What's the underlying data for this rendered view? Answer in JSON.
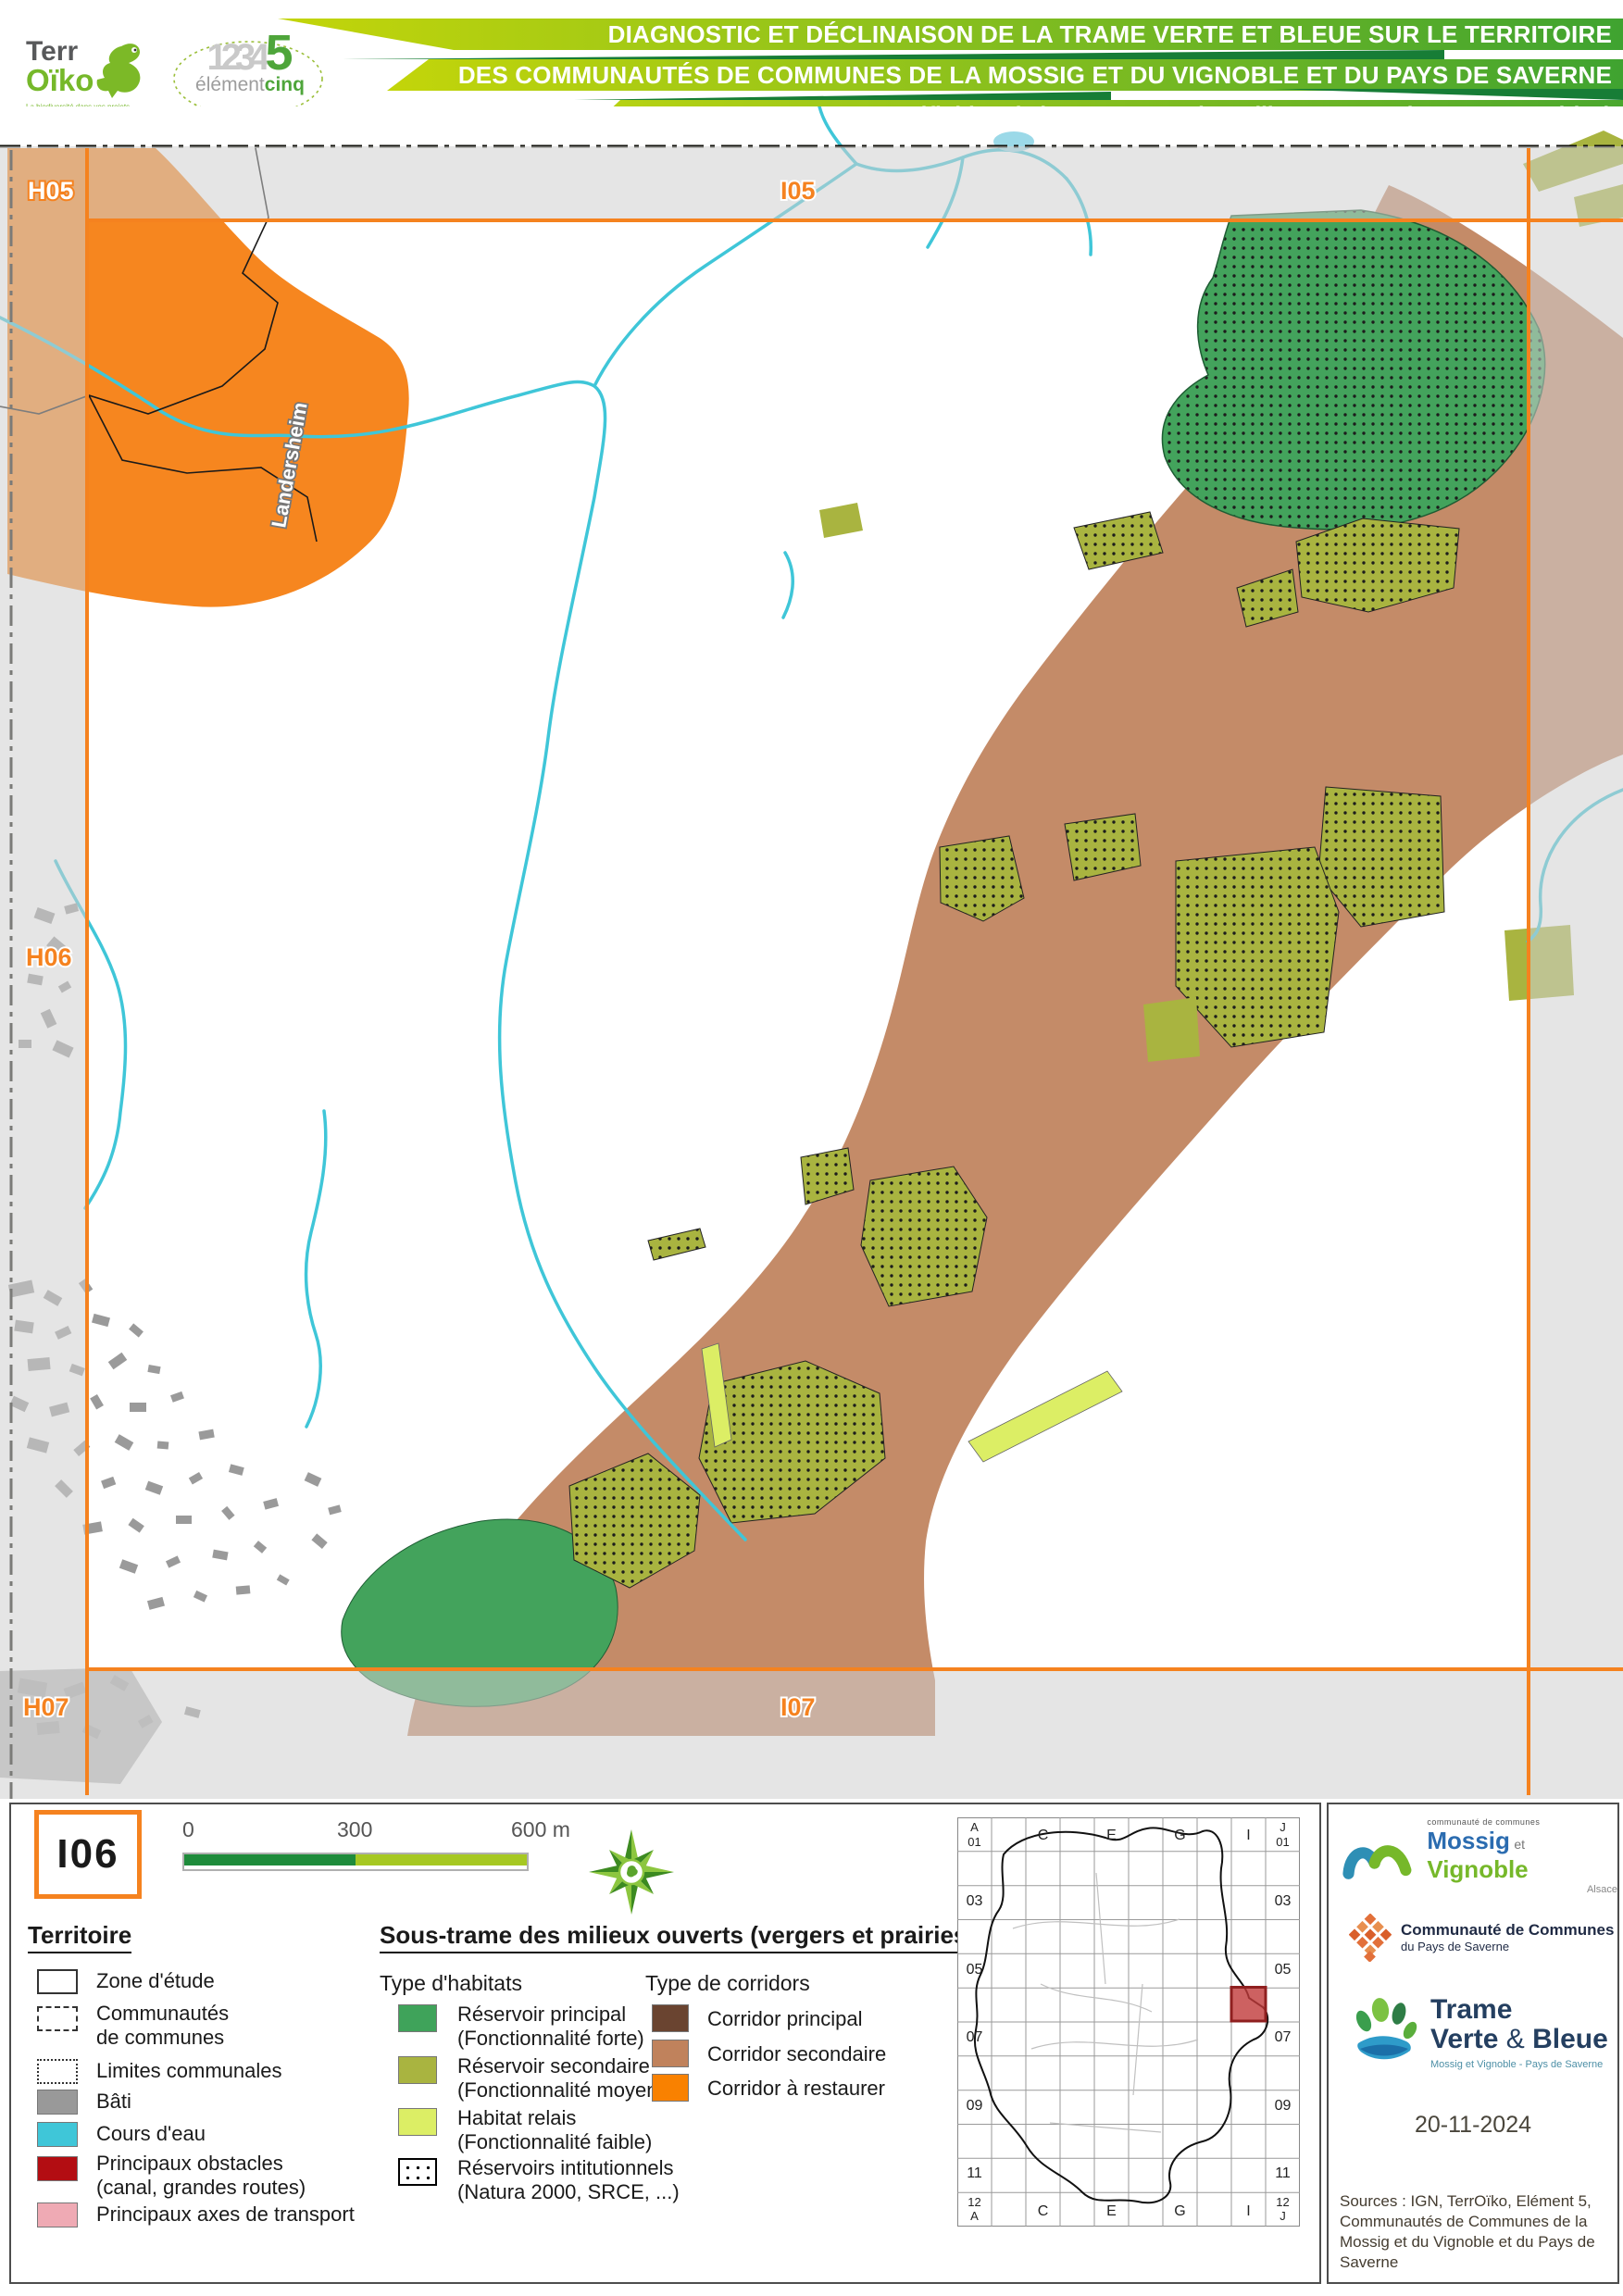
{
  "header": {
    "terroiko": {
      "line1": "Terr",
      "line2": "Oïko",
      "tagline": "La biodiversité dans vos projets"
    },
    "element5": {
      "numbers": "1234",
      "five": "5",
      "word1": "élément",
      "word2": "cinq"
    },
    "title_line1": "DIAGNOSTIC ET DÉCLINAISON DE LA TRAME VERTE ET BLEUE SUR LE TERRITOIRE",
    "title_line2": "DES COMMUNAUTÉS DE COMMUNES DE LA MOSSIG ET DU VIGNOBLE ET DU PAYS DE SAVERNE",
    "title_line3": "Définition de la sous-trame des milieux ouverts (vergers et prairies)"
  },
  "map": {
    "labels": {
      "top_left": "H05",
      "top": "I05",
      "left": "H06",
      "bottom_left": "H07",
      "bottom": "I07"
    },
    "place": "Landersheim"
  },
  "legend": {
    "sheet_id": "I06",
    "scale": {
      "t0": "0",
      "t300": "300",
      "t600": "600 m",
      "color_left": "#1e8b3b",
      "color_right": "#a6c822"
    },
    "territoire": {
      "heading": "Territoire",
      "items": [
        {
          "label": "Zone d'étude"
        },
        {
          "label": "Communautés de communes"
        },
        {
          "label": "Limites communales"
        },
        {
          "label": "Bâti",
          "color": "#999999"
        },
        {
          "label": "Cours d'eau",
          "color": "#3fc6d8"
        },
        {
          "label": "Principaux obstacles (canal, grandes routes)",
          "color": "#b30d12"
        },
        {
          "label": "Principaux axes de transport",
          "color": "#efaab4"
        }
      ]
    },
    "soustrame": {
      "heading": "Sous-trame des milieux ouverts (vergers et prairies)",
      "habitats_heading": "Type d'habitats",
      "habitats": [
        {
          "label": "Réservoir principal",
          "sub": "(Fonctionnalité forte)",
          "color": "#3fa35a"
        },
        {
          "label": "Réservoir secondaire",
          "sub": "(Fonctionnalité moyenne)",
          "color": "#a9b440"
        },
        {
          "label": "Habitat relais",
          "sub": "(Fonctionnalité faible)",
          "color": "#dcee65"
        },
        {
          "label": "Réservoirs intitutionnels",
          "sub": "(Natura 2000, SRCE, ...)"
        }
      ],
      "corridors_heading": "Type de corridors",
      "corridors": [
        {
          "label": "Corridor principal",
          "color": "#6a4430"
        },
        {
          "label": "Corridor secondaire",
          "color": "#c0825c"
        },
        {
          "label": "Corridor à restaurer",
          "color": "#f98100"
        }
      ]
    },
    "inset": {
      "tl_letter": "A",
      "tl_num": "01",
      "tr_letter": "J",
      "tr_num": "01",
      "bl_num": "12",
      "bl_letter": "A",
      "br_num": "12",
      "br_letter": "J",
      "rows": [
        "03",
        "05",
        "07",
        "09",
        "11"
      ],
      "cols": [
        "C",
        "E",
        "G",
        "I"
      ]
    }
  },
  "credits": {
    "mossig": {
      "small": "communauté de communes",
      "name1": "Mossig",
      "et": "et",
      "name2": "Vignoble",
      "region": "Alsace"
    },
    "saverne": {
      "line1": "Communauté de Communes",
      "line2": "du Pays de Saverne"
    },
    "tvb": {
      "line1": "Trame",
      "line2a": "Verte",
      "amp": "&",
      "line2b": "Bleue",
      "sub": "Mossig et Vignoble - Pays de Saverne"
    },
    "date": "20-11-2024",
    "sources": "Sources : IGN, TerrOïko, Elément 5, Communautés de Communes de la Mossig et du Vignoble et du Pays de Saverne"
  }
}
